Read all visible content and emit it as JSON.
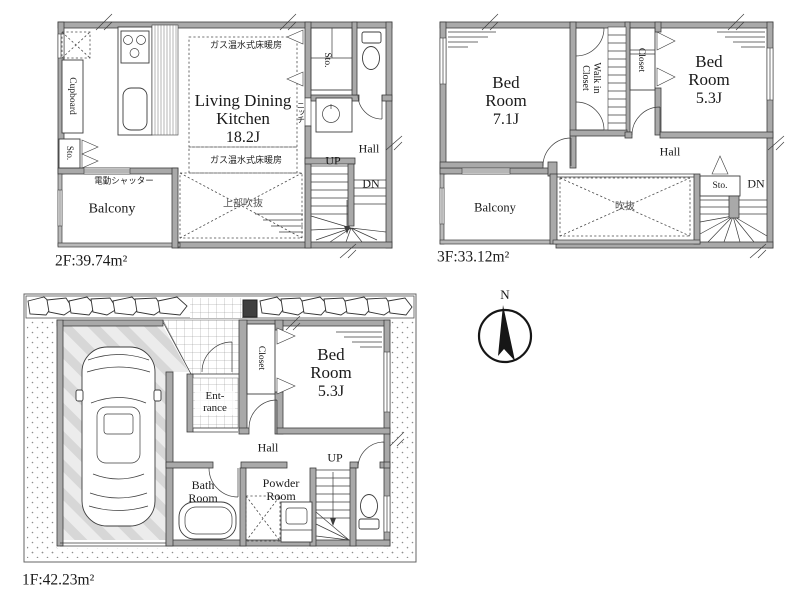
{
  "colors": {
    "wall": "#a9a9a9",
    "line": "#3c3c3c",
    "text": "#1a1a1a"
  },
  "compass": {
    "north_label": "N"
  },
  "floor2": {
    "area_label": "2F:39.74m²",
    "ldk_name": "Living Dining Kitchen",
    "ldk_size": "18.2J",
    "floor_heating_top": "ガス温水式床暖房",
    "floor_heating_bottom": "ガス温水式床暖房",
    "void_label": "上部吹抜",
    "shutter_label": "電動シャッター",
    "balcony": "Balcony",
    "cupboard": "Cupboard",
    "storage_left": "Sto.",
    "storage_right": "Sto.",
    "niche": "ニッチ",
    "hall": "Hall",
    "up": "UP",
    "dn": "DN"
  },
  "floor3": {
    "area_label": "3F:33.12m²",
    "bedroom_a_name": "Bed Room",
    "bedroom_a_size": "7.1J",
    "bedroom_b_name": "Bed Room",
    "bedroom_b_size": "5.3J",
    "walk_in_closet": "Walk in Closet",
    "closet": "Closet",
    "hall": "Hall",
    "storage": "Sto.",
    "dn": "DN",
    "balcony": "Balcony",
    "void_label": "吹抜"
  },
  "floor1": {
    "area_label": "1F:42.23m²",
    "bedroom_name": "Bed Room",
    "bedroom_size": "5.3J",
    "closet": "Closet",
    "entrance": "Ent-rance",
    "hall": "Hall",
    "up": "UP",
    "bath": "Bath Room",
    "powder": "Powder Room"
  }
}
